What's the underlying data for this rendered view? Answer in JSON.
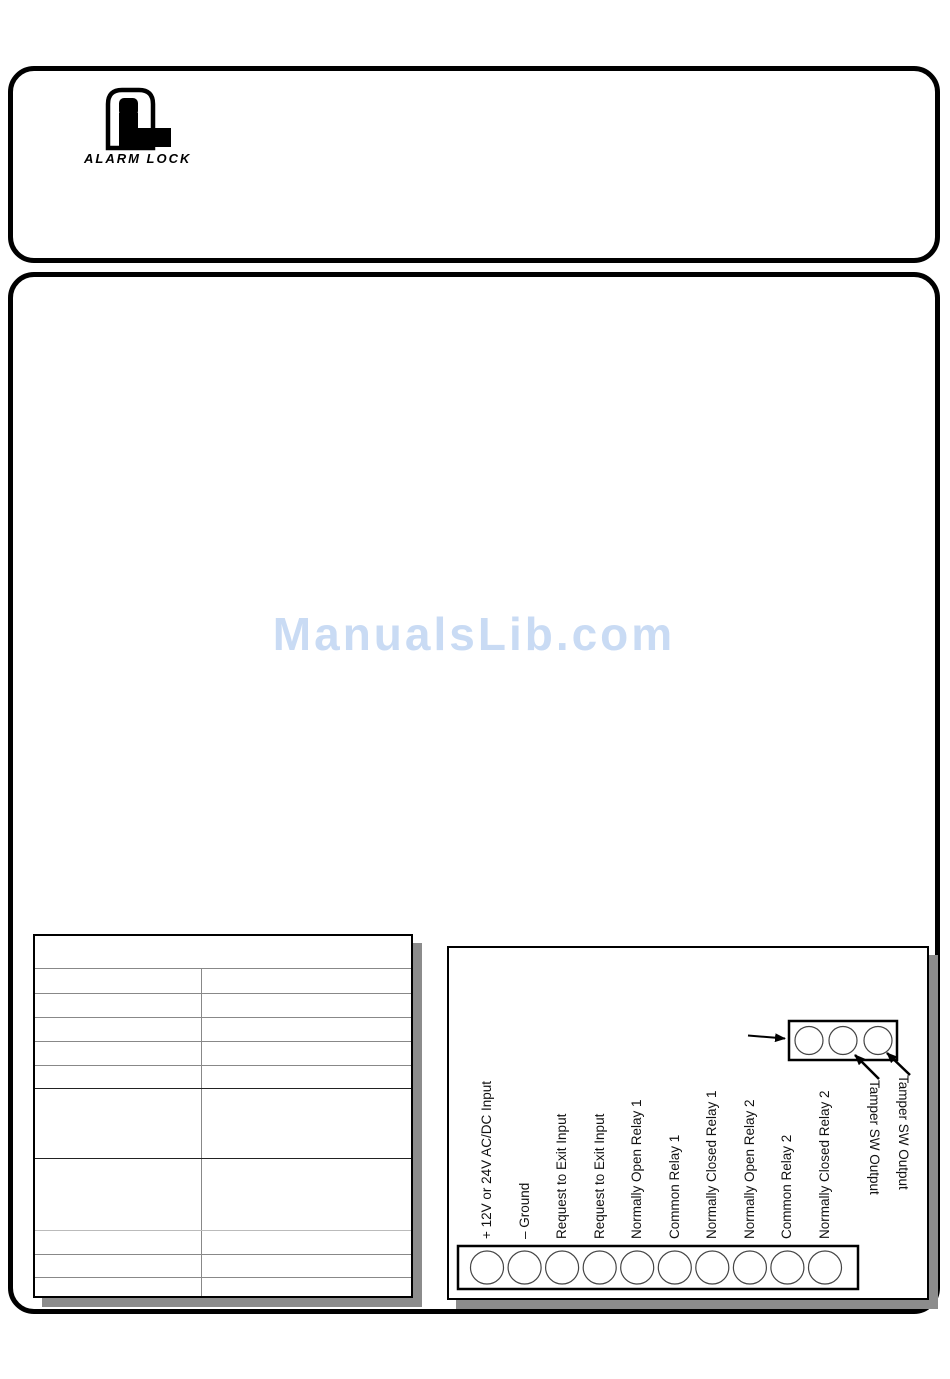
{
  "brand": {
    "name": "ALARM LOCK"
  },
  "watermark": {
    "text": "ManualsLib.com",
    "color": "#c9dbf4"
  },
  "diagram": {
    "terminal_labels": [
      "+ 12V or 24V AC/DC Input",
      "– Ground",
      "Request to Exit Input",
      "Request to Exit Input",
      "Normally Open Relay 1",
      "Common Relay 1",
      "Normally Closed Relay 1",
      "Normally Open Relay 2",
      "Common Relay 2",
      "Normally Closed Relay 2"
    ],
    "tamper_labels": [
      "Tamper SW Output",
      "Tamper SW Output"
    ]
  }
}
